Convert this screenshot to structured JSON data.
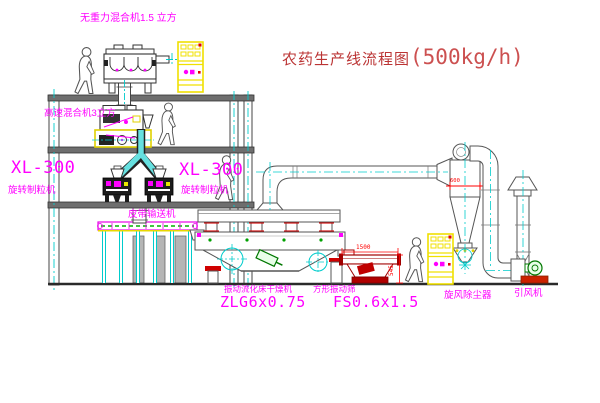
{
  "title": {
    "name": "农药生产线流程图",
    "capacity": "(500kg/h)"
  },
  "equipment": {
    "gravity_mixer": {
      "label": "无重力混合机1.5 立方"
    },
    "high_speed_mixer": {
      "label": "高速混合机3立方"
    },
    "granulator_left": {
      "model": "XL-300",
      "name": "旋转制粒机"
    },
    "granulator_right": {
      "model": "XL-300",
      "name": "旋转制粒机"
    },
    "belt_conveyor": {
      "label": "皮带输送机"
    },
    "fluid_bed_dryer": {
      "name": "振动流化床干燥机",
      "model": "ZLG6x0.75"
    },
    "vibrating_screen": {
      "name": "方形振动筛",
      "model": "FS0.6x1.5",
      "dim_length": "1500",
      "dim_height": "545"
    },
    "cyclone": {
      "name": "旋风除尘器",
      "dim": "600"
    },
    "induced_fan": {
      "name": "引风机"
    }
  },
  "colors": {
    "label_magenta": "#ff00ff",
    "title_red": "#bb3434",
    "dimension_red": "#ff0000",
    "cabinet_yellow": "#f0e000",
    "centerline_cyan": "#00cccc",
    "screen_dark_red": "#a00000",
    "belt_green": "#00b000"
  }
}
